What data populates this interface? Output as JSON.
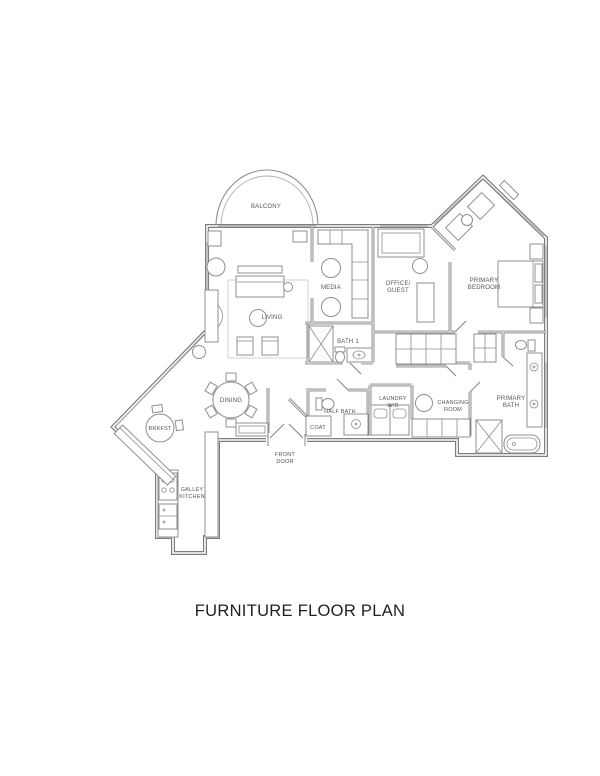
{
  "page": {
    "title": "FURNITURE FLOOR PLAN"
  },
  "colors": {
    "wall-color": "#7d7d7d",
    "window-color": "#b0b0b0",
    "furniture-color": "#8f8f8f",
    "label-color": "#555555",
    "title-color": "#1f1f1f",
    "background": "#ffffff"
  },
  "rooms": {
    "balcony": {
      "label": "BALCONY"
    },
    "living": {
      "label": "LIVING"
    },
    "media": {
      "label": "MEDIA"
    },
    "office_guest": {
      "line1": "OFFICE/",
      "line2": "GUEST"
    },
    "primary_bedroom": {
      "line1": "PRIMARY",
      "line2": "BEDROOM"
    },
    "bath_1": {
      "label": "BATH 1"
    },
    "half_bath": {
      "label": "HALF BATH"
    },
    "laundry": {
      "line1": "LAUNDRY",
      "line2": "W/D"
    },
    "changing_room": {
      "line1": "CHANGING",
      "line2": "ROOM"
    },
    "primary_bath": {
      "line1": "PRIMARY",
      "line2": "BATH"
    },
    "coat": {
      "label": "COAT"
    },
    "front_door": {
      "line1": "FRONT",
      "line2": "DOOR"
    },
    "dining": {
      "label": "DINING"
    },
    "breakfast": {
      "label": "BRKFST"
    },
    "galley_kitchen": {
      "line1": "GALLEY",
      "line2": "KITCHEN"
    }
  }
}
